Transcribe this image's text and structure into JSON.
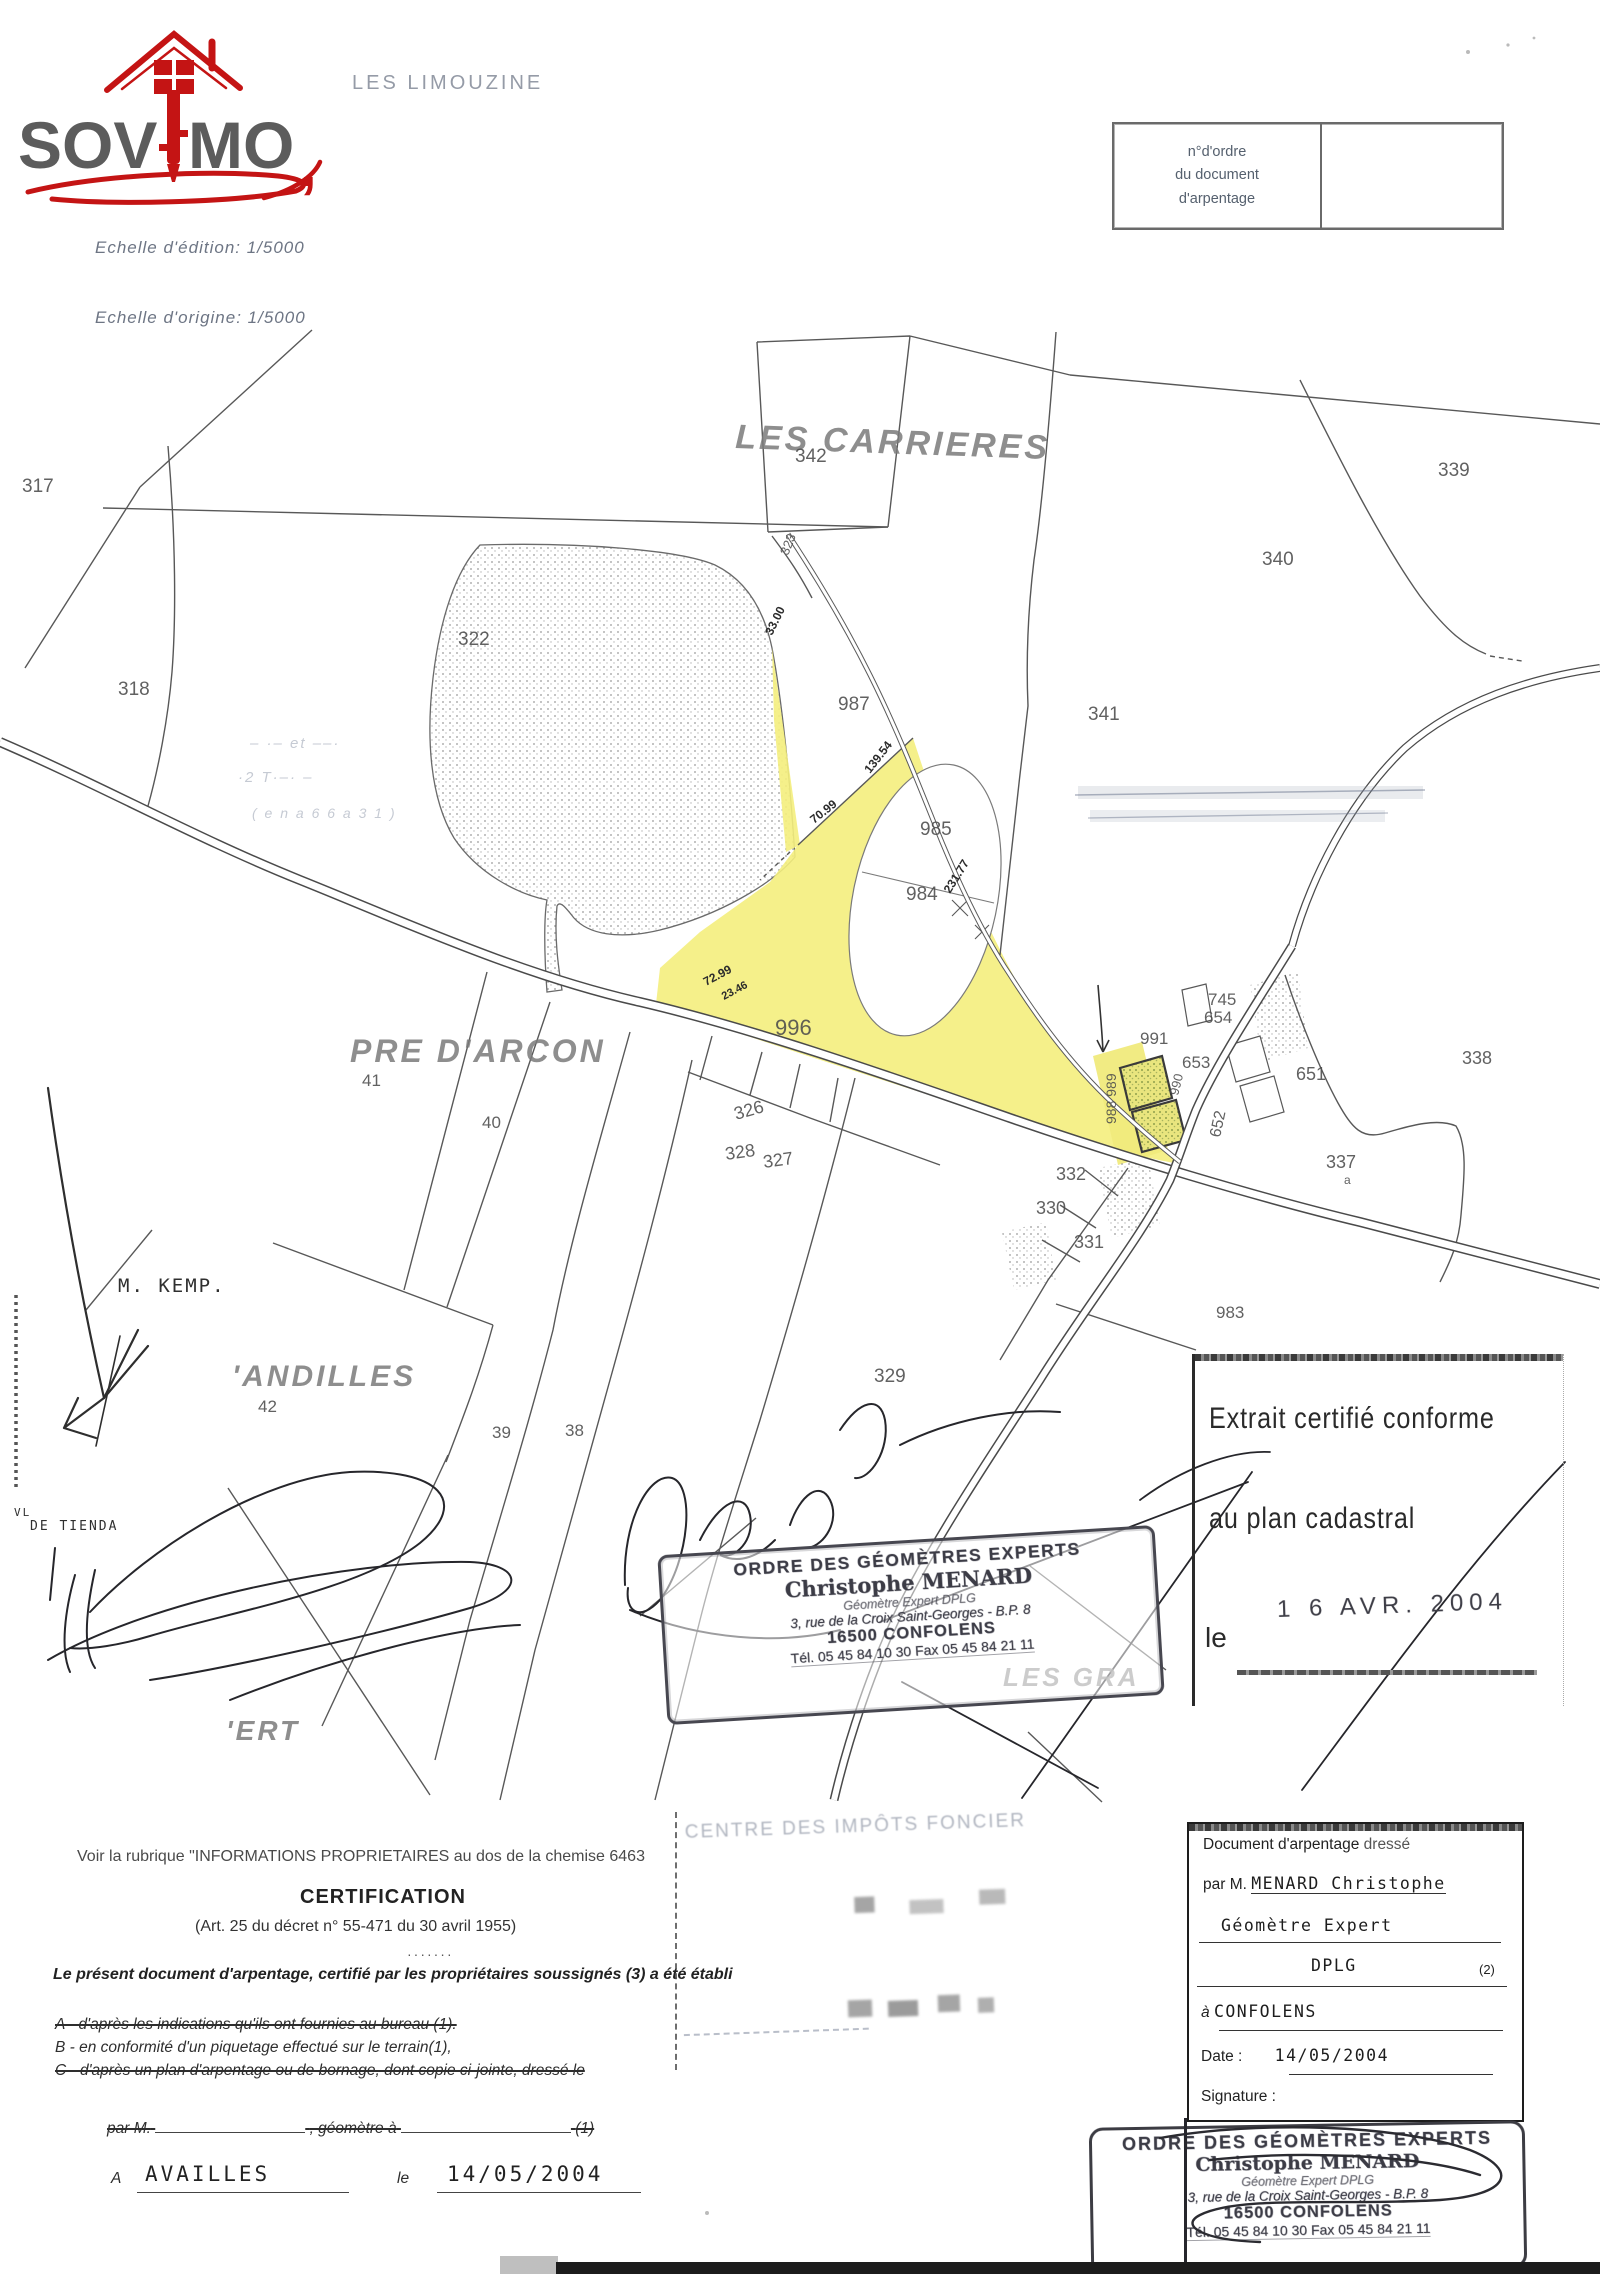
{
  "colors": {
    "accent_red": "#c41414",
    "ink": "#333333",
    "stamp_ink": "#3f3f49",
    "highlight_yellow": "#f4ee7d"
  },
  "header": {
    "logo_sov": "SOV",
    "logo_mo": "MO",
    "logo_comma": ",",
    "place_top": "LES LIMOUZINE",
    "order_box_l1": "n°d'ordre",
    "order_box_l2": "du document",
    "order_box_l3": "d'arpentage",
    "scale_edition": "Echelle d'édition: 1/5000",
    "scale_origin": "Echelle d'origine: 1/5000"
  },
  "map": {
    "labels": [
      {
        "t": "LES CARRIERES",
        "x": 735,
        "y": 448,
        "s": 34,
        "r": 2,
        "c": "place"
      },
      {
        "t": "PRE D'ARCON",
        "x": 350,
        "y": 1062,
        "s": 32,
        "c": "place"
      },
      {
        "t": "'ANDILLES",
        "x": 232,
        "y": 1386,
        "s": 30,
        "c": "place"
      },
      {
        "t": "'ERT",
        "x": 226,
        "y": 1740,
        "s": 28,
        "c": "place"
      },
      {
        "t": "LES GRA",
        "x": 1003,
        "y": 1686,
        "s": 26,
        "c": "place"
      },
      {
        "t": "317",
        "x": 22,
        "y": 492,
        "s": 19,
        "c": "parcel"
      },
      {
        "t": "318",
        "x": 118,
        "y": 695,
        "s": 19,
        "c": "parcel"
      },
      {
        "t": "322",
        "x": 458,
        "y": 645,
        "s": 19,
        "c": "parcel"
      },
      {
        "t": "342",
        "x": 795,
        "y": 462,
        "s": 19,
        "c": "parcel"
      },
      {
        "t": "323",
        "x": 788,
        "y": 556,
        "s": 13,
        "r": -68,
        "c": "parcel"
      },
      {
        "t": "339",
        "x": 1438,
        "y": 476,
        "s": 19,
        "c": "parcel"
      },
      {
        "t": "340",
        "x": 1262,
        "y": 565,
        "s": 19,
        "c": "parcel"
      },
      {
        "t": "341",
        "x": 1088,
        "y": 720,
        "s": 19,
        "c": "parcel"
      },
      {
        "t": "987",
        "x": 838,
        "y": 710,
        "s": 19,
        "c": "parcel"
      },
      {
        "t": "985",
        "x": 920,
        "y": 835,
        "s": 19,
        "c": "parcel"
      },
      {
        "t": "984",
        "x": 906,
        "y": 900,
        "s": 19,
        "c": "parcel"
      },
      {
        "t": "996",
        "x": 775,
        "y": 1035,
        "s": 22,
        "c": "parcel"
      },
      {
        "t": "745",
        "x": 1208,
        "y": 1005,
        "s": 17,
        "c": "parcel"
      },
      {
        "t": "654",
        "x": 1204,
        "y": 1023,
        "s": 17,
        "c": "parcel"
      },
      {
        "t": "991",
        "x": 1140,
        "y": 1044,
        "s": 17,
        "c": "parcel"
      },
      {
        "t": "653",
        "x": 1182,
        "y": 1068,
        "s": 17,
        "c": "parcel"
      },
      {
        "t": "990",
        "x": 1178,
        "y": 1096,
        "s": 13,
        "r": -76,
        "c": "parcel"
      },
      {
        "t": "988 989",
        "x": 1116,
        "y": 1124,
        "s": 14,
        "r": -90,
        "c": "parcel"
      },
      {
        "t": "651",
        "x": 1296,
        "y": 1080,
        "s": 18,
        "c": "parcel"
      },
      {
        "t": "652",
        "x": 1220,
        "y": 1138,
        "s": 16,
        "r": -78,
        "c": "parcel"
      },
      {
        "t": "338",
        "x": 1462,
        "y": 1064,
        "s": 18,
        "c": "parcel"
      },
      {
        "t": "337",
        "x": 1326,
        "y": 1168,
        "s": 18,
        "c": "parcel"
      },
      {
        "t": "a",
        "x": 1344,
        "y": 1184,
        "s": 12,
        "c": "parcel"
      },
      {
        "t": "326",
        "x": 736,
        "y": 1120,
        "s": 18,
        "r": -16,
        "c": "parcel"
      },
      {
        "t": "328",
        "x": 726,
        "y": 1160,
        "s": 18,
        "r": -8,
        "c": "parcel"
      },
      {
        "t": "327",
        "x": 764,
        "y": 1168,
        "s": 18,
        "r": -8,
        "c": "parcel"
      },
      {
        "t": "332",
        "x": 1056,
        "y": 1180,
        "s": 18,
        "c": "parcel"
      },
      {
        "t": "330",
        "x": 1036,
        "y": 1214,
        "s": 18,
        "c": "parcel"
      },
      {
        "t": "331",
        "x": 1074,
        "y": 1248,
        "s": 18,
        "c": "parcel"
      },
      {
        "t": "329",
        "x": 874,
        "y": 1382,
        "s": 19,
        "c": "parcel"
      },
      {
        "t": "983",
        "x": 1216,
        "y": 1318,
        "s": 17,
        "c": "parcel"
      },
      {
        "t": "41",
        "x": 362,
        "y": 1086,
        "s": 17,
        "c": "parcel"
      },
      {
        "t": "40",
        "x": 482,
        "y": 1128,
        "s": 17,
        "c": "parcel"
      },
      {
        "t": "42",
        "x": 258,
        "y": 1412,
        "s": 17,
        "c": "parcel"
      },
      {
        "t": "39",
        "x": 492,
        "y": 1438,
        "s": 17,
        "c": "parcel"
      },
      {
        "t": "38",
        "x": 565,
        "y": 1436,
        "s": 17,
        "c": "parcel"
      },
      {
        "t": "33.00",
        "x": 772,
        "y": 636,
        "s": 12,
        "r": -64,
        "c": "dim"
      },
      {
        "t": "139.54",
        "x": 870,
        "y": 774,
        "s": 12,
        "r": -52,
        "c": "dim"
      },
      {
        "t": "70.99",
        "x": 814,
        "y": 824,
        "s": 12,
        "r": -38,
        "c": "dim"
      },
      {
        "t": "231.77",
        "x": 950,
        "y": 894,
        "s": 12,
        "r": -58,
        "c": "dim"
      },
      {
        "t": "72.99",
        "x": 706,
        "y": 986,
        "s": 12,
        "r": -28,
        "c": "dim"
      },
      {
        "t": "23.46",
        "x": 724,
        "y": 1000,
        "s": 11,
        "r": -28,
        "c": "dim"
      },
      {
        "t": "M. KEMP.",
        "x": 118,
        "y": 1292,
        "s": 19,
        "c": "hand"
      },
      {
        "t": "VL",
        "x": 14,
        "y": 1516,
        "s": 11,
        "c": "hand"
      },
      {
        "t": "DE TIENDA",
        "x": 30,
        "y": 1530,
        "s": 13,
        "c": "hand"
      },
      {
        "t": "– ·– et ––·",
        "x": 250,
        "y": 748,
        "s": 15,
        "c": "faint"
      },
      {
        "t": "·2 T·–· –",
        "x": 238,
        "y": 782,
        "s": 15,
        "c": "faint"
      },
      {
        "t": "( e n a 6 6 a 3 1 )",
        "x": 252,
        "y": 818,
        "s": 14,
        "c": "faint"
      }
    ]
  },
  "stamps": {
    "geometre_l1": "ORDRE DES GÉOMÈTRES EXPERTS",
    "geometre_l2": "Christophe MENARD",
    "geometre_l3": "Géomètre Expert DPLG",
    "geometre_l4": "3, rue de la Croix Saint-Georges - B.P. 8",
    "geometre_l5": "16500 CONFOLENS",
    "geometre_l6": "Tél. 05 45 84 10 30  Fax 05 45 84 21 11",
    "impots_l1": "CENTRE DES IMPÔTS FONCIER"
  },
  "extrait": {
    "l1": "Extrait certifié conforme",
    "l2": "au plan cadastral",
    "date": "1 6 AVR. 2004",
    "le": "le"
  },
  "certification": {
    "voir": "Voir la rubrique \"INFORMATIONS PROPRIETAIRES au dos de la chemise 6463",
    "title": "CERTIFICATION",
    "art": "(Art. 25 du décret n° 55-471 du 30 avril 1955)",
    "dots": "·······",
    "intro": "Le présent document d'arpentage, certifié par les propriétaires soussignés (3)  a été établi",
    "line_a": "A - d'après les indications qu'ils ont fournies au bureau (1).",
    "line_b": "B - en conformité d'un piquetage effectué sur le terrain(1),",
    "line_c": "C - d'après un plan d'arpentage ou de bornage, dont copie ci-jointe, dressé le",
    "par_pre": "par M.",
    "par_mid": ", géomètre à",
    "par_suf": "(1)",
    "a": "A",
    "place": "AVAILLES",
    "le": "le",
    "date": "14/05/2004"
  },
  "arpentage_box": {
    "l1_a": "Document d'arpentage",
    "l1_b": "dressé",
    "l2_pre": "par M.",
    "l2_val": "MENARD Christophe",
    "l3": "Géomètre Expert",
    "l4": "DPLG",
    "l4_suf": "(2)",
    "l5_pre": "à",
    "l5_val": "CONFOLENS",
    "l6_pre": "Date :",
    "l6_val": "14/05/2004",
    "l7": "Signature :"
  }
}
